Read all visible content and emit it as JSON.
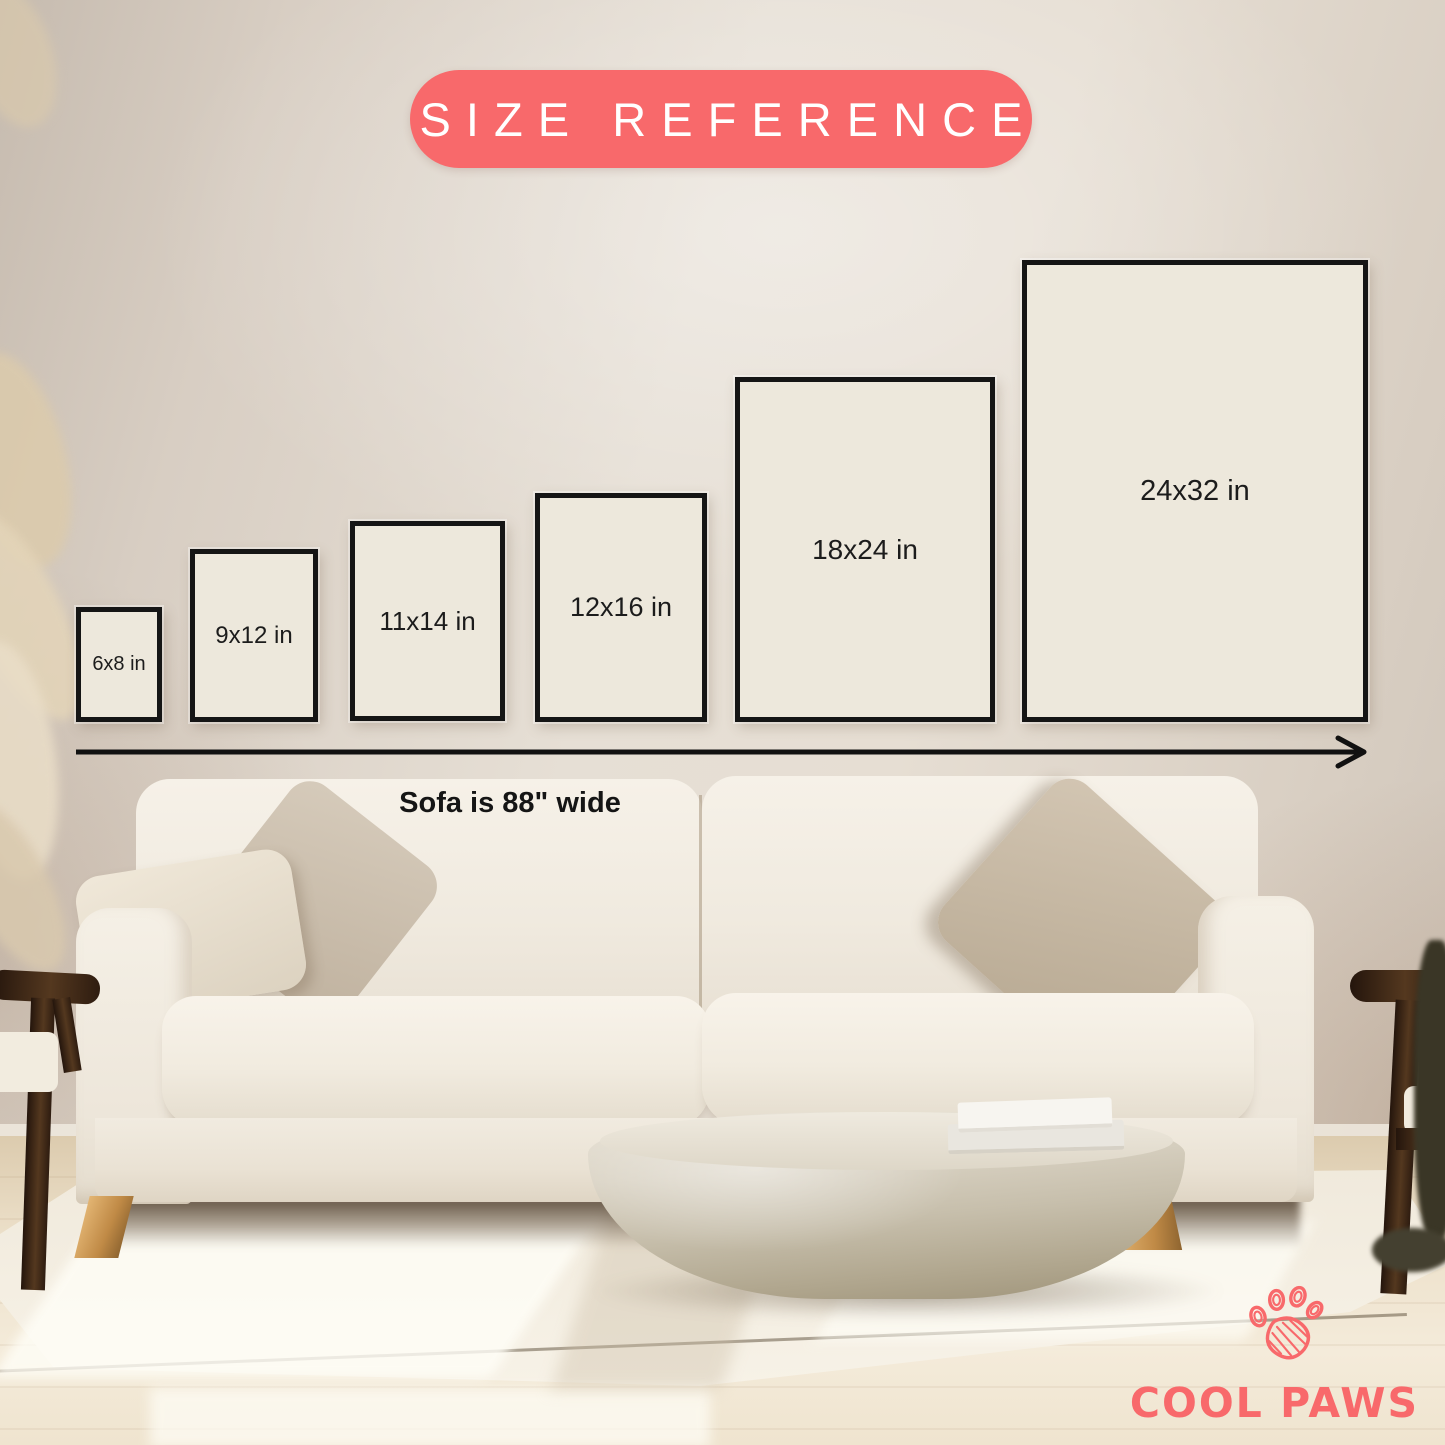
{
  "title_badge": {
    "label": "SIZE REFERENCE"
  },
  "size_boxes": [
    {
      "label": "6x8 in",
      "width_in": 6,
      "height_in": 8
    },
    {
      "label": "9x12 in",
      "width_in": 9,
      "height_in": 12
    },
    {
      "label": "11x14 in",
      "width_in": 11,
      "height_in": 14
    },
    {
      "label": "12x16 in",
      "width_in": 12,
      "height_in": 16
    },
    {
      "label": "18x24 in",
      "width_in": 18,
      "height_in": 24
    },
    {
      "label": "24x32 in",
      "width_in": 24,
      "height_in": 32
    }
  ],
  "scale_note": {
    "caption": "Sofa is 88\" wide"
  },
  "brand": {
    "name": "COOL PAWS",
    "icon": "paw-print-icon"
  },
  "colors": {
    "accent": "#F8696B",
    "box_fill": "#EDE8DC",
    "box_border": "#151515",
    "arrow": "#111111",
    "wall": "#E2DACF",
    "sofa": "#F2EDE3"
  }
}
